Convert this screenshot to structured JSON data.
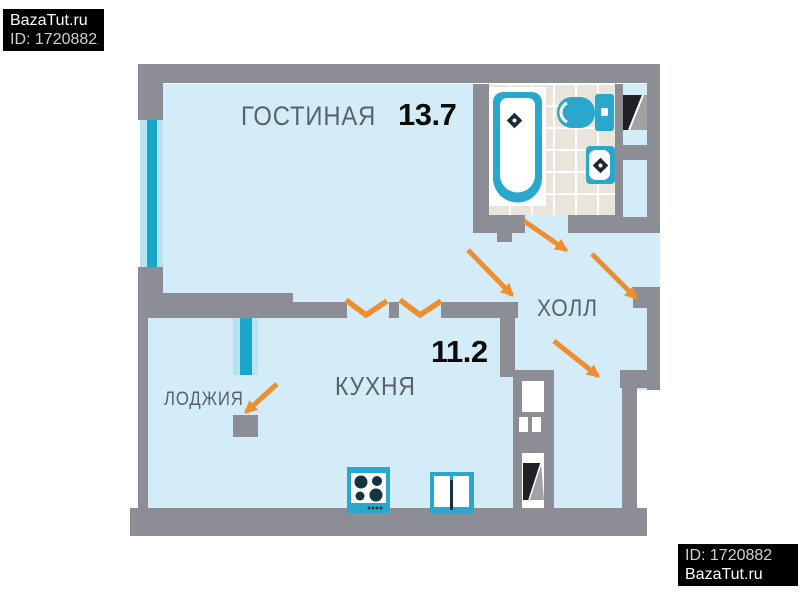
{
  "watermark_top_left": {
    "line1": "BazaTut.ru",
    "line2": "ID: 1720882"
  },
  "watermark_bottom_right": {
    "line1": "ID: 1720882",
    "line2": "BazaTut.ru"
  },
  "rooms": {
    "living": {
      "label": "ГОСТИНАЯ",
      "area": "13.7"
    },
    "kitchen": {
      "label": "КУХНЯ",
      "area": "11.2"
    },
    "hall": {
      "label": "ХОЛЛ"
    },
    "loggia": {
      "label": "ЛОДЖИЯ"
    }
  },
  "colors": {
    "wall": "#8d8d95",
    "floor": "#d3ecf7",
    "window_glass": "#18a6cc",
    "window_frame": "#b9e2f1",
    "door_swing": "#ef8e2e",
    "bathroom_tile": "#e9e5db",
    "fixture_teal": "#29a7cd",
    "burner_dark": "#14323f",
    "vent_black": "#212125",
    "vent_gray": "#a2a2a6",
    "label_text": "#57636b",
    "area_text": "#0c0c0c",
    "watermark_bg": "#000000",
    "watermark_text": "#ffffff"
  },
  "icons": [
    "bathtub-icon",
    "toilet-icon",
    "washbasin-icon",
    "stove-icon",
    "kitchen-sink-icon",
    "vent-duct-icon",
    "door-swing-icon",
    "wall-opening-icon",
    "window-icon"
  ]
}
